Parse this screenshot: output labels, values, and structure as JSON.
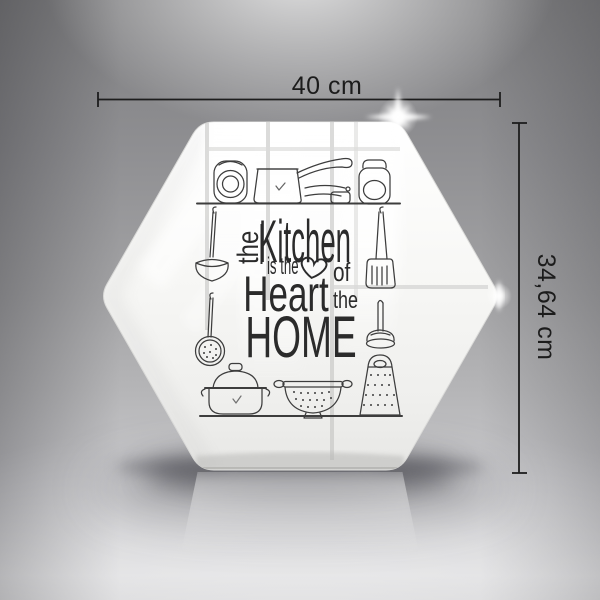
{
  "dimensions": {
    "width_label": "40 cm",
    "height_label": "34,64 cm"
  },
  "panel_text": {
    "the_vertical": "the",
    "kitchen": "Kitchen",
    "is_the": "is the",
    "of": "of",
    "heart_word": "Heart",
    "the_small": "the",
    "home": "HOME"
  },
  "colors": {
    "design_ink": "#2b2b2b",
    "utensil_ink": "#3d3d3d",
    "dimension_ink": "#1c1c1c",
    "glass_white": "#f7f7f5",
    "background_gray": "#a2a2a4"
  }
}
